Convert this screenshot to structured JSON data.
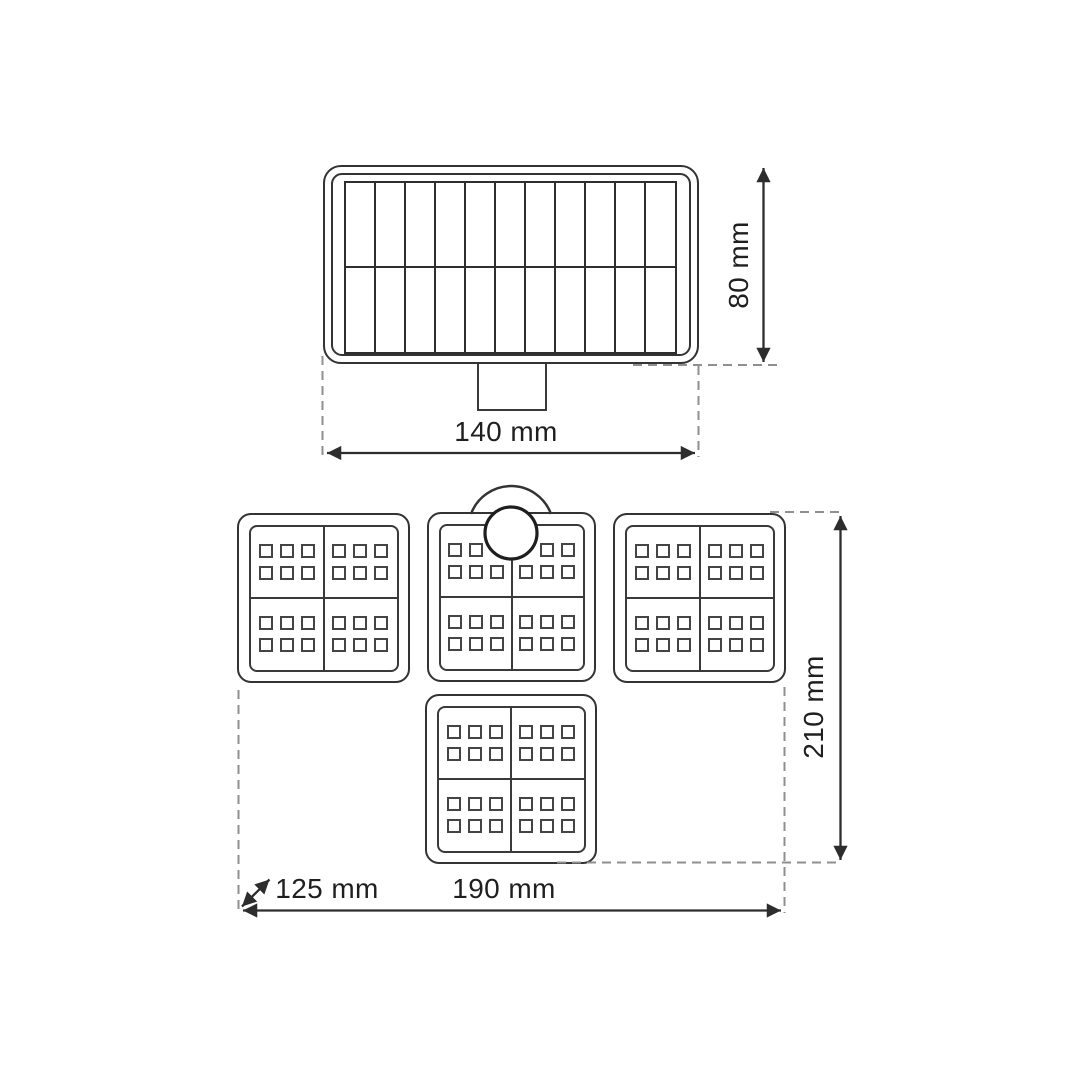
{
  "diagram": {
    "type": "product-dimension-drawing",
    "product": "solar-led-floodlight",
    "top_view": {
      "name": "solar-panel-top-view",
      "width_label": "140 mm",
      "height_label": "80 mm",
      "solar_cell_columns": 11,
      "solar_cell_rows": 2
    },
    "front_view": {
      "name": "led-light-front-view",
      "width_label": "190 mm",
      "height_label": "210 mm",
      "depth_label": "125 mm",
      "led_panel_count": 4,
      "quadrants_per_panel": 4,
      "led_columns_per_quadrant": 3,
      "led_rows_per_quadrant": 2,
      "has_pir_sensor": true
    },
    "colors": {
      "line": "#2d2d2d",
      "panel_line": "#333333",
      "dashed_line": "#8f8f8f",
      "text": "#1f1f1f",
      "background": "#ffffff"
    }
  }
}
